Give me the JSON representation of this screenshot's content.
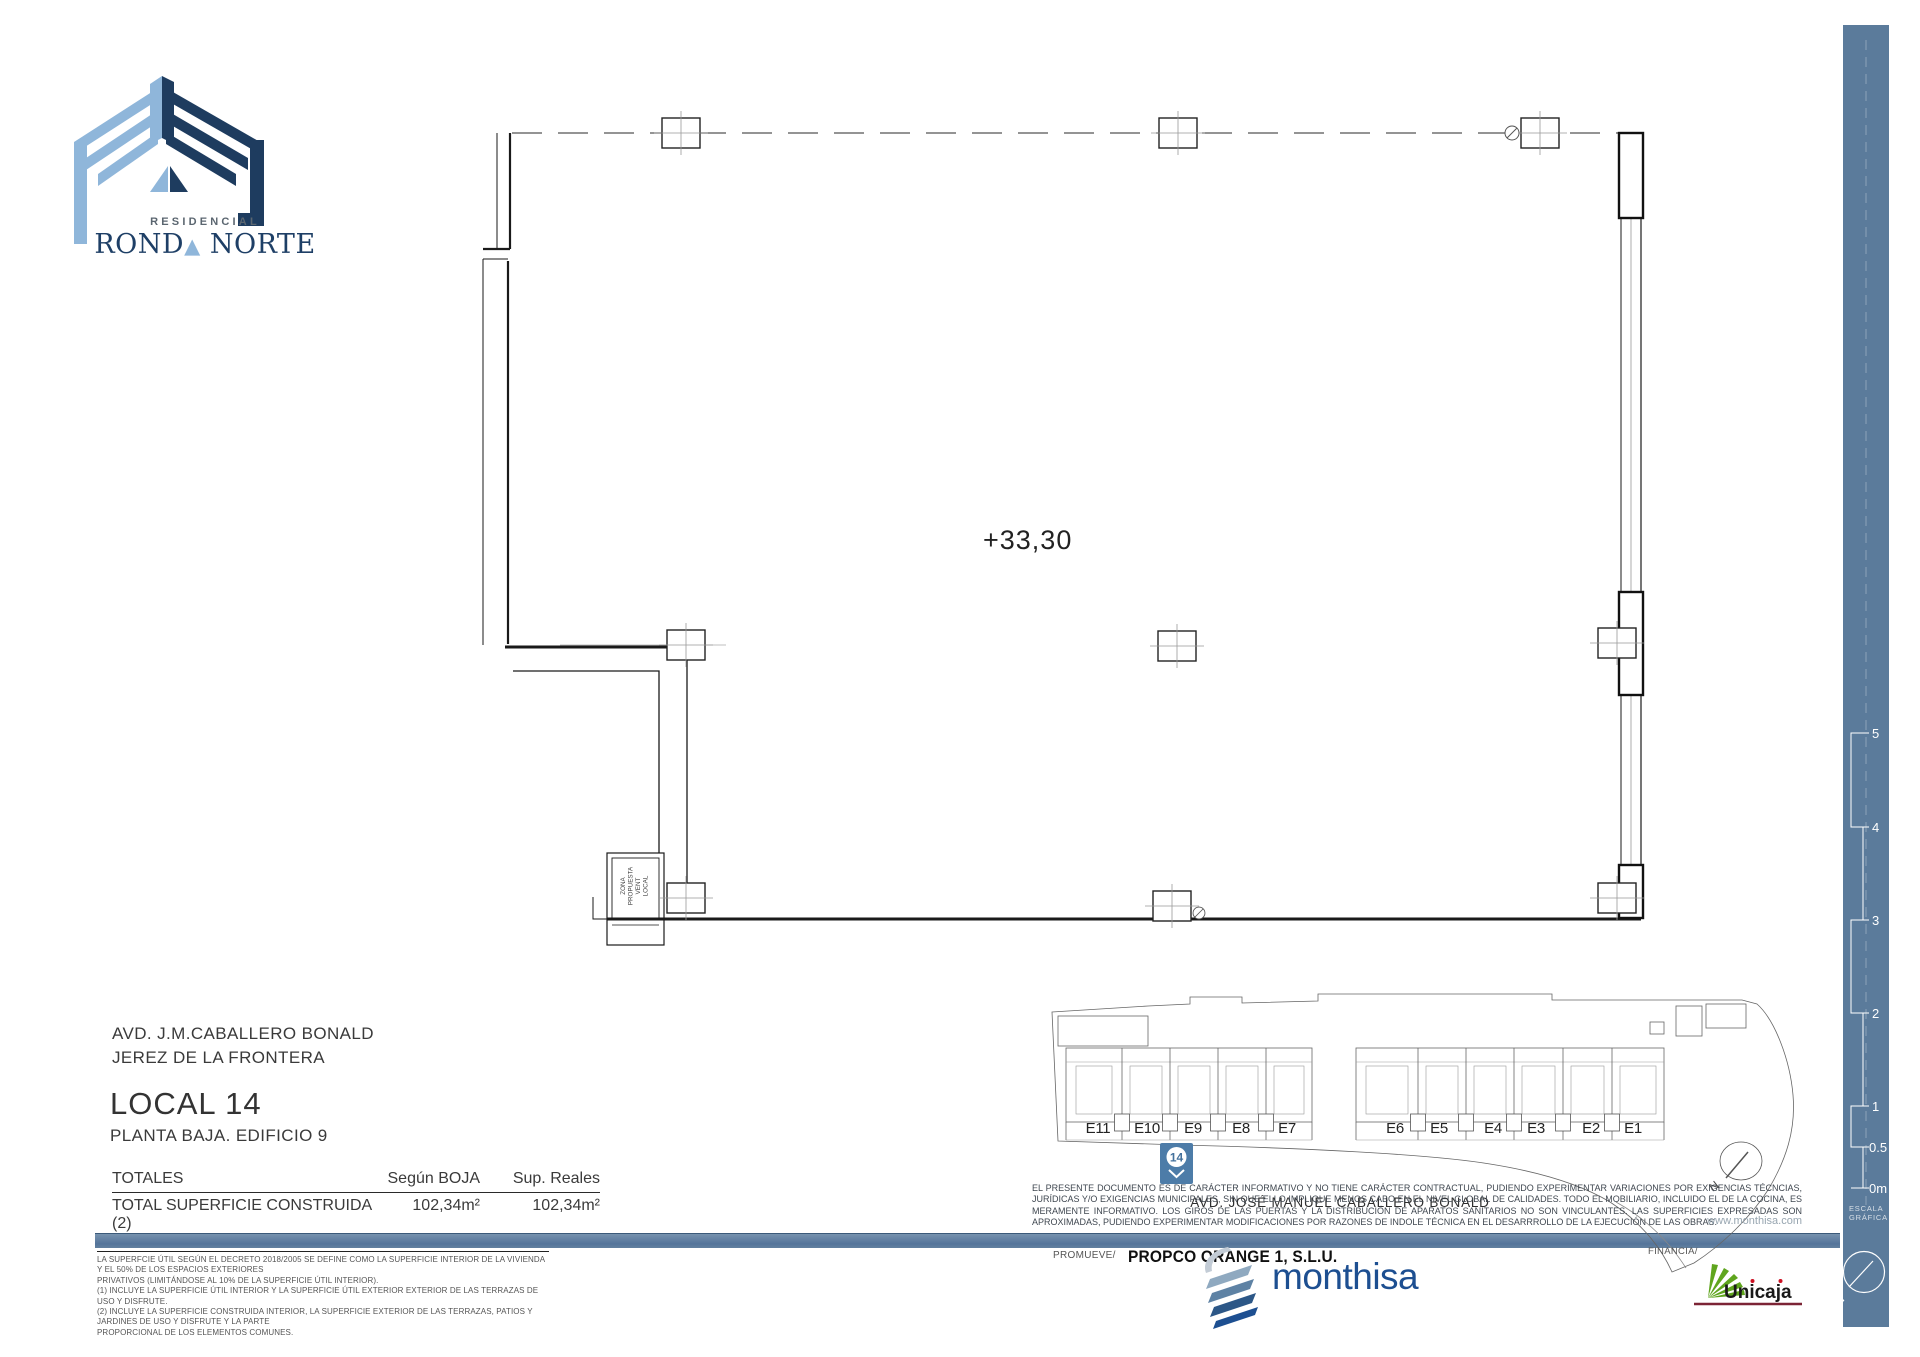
{
  "brand": {
    "residencial": "RESIDENCIAL",
    "name_part1": "ROND",
    "name_triangle": "▲",
    "name_part2": " NORTE"
  },
  "plan": {
    "level_label": "+33,30",
    "vent_room": {
      "line1": "ZONA",
      "line2": "PROPUESTA",
      "line3": "VENT",
      "line4": "LOCAL"
    }
  },
  "project": {
    "address_line1": "AVD. J.M.CABALLERO BONALD",
    "address_line2": "JEREZ DE LA FRONTERA",
    "unit_title": "LOCAL 14",
    "unit_subtitle": "PLANTA BAJA. EDIFICIO 9"
  },
  "totals": {
    "title": "TOTALES",
    "col_boja": "Según BOJA",
    "col_reales": "Sup. Reales",
    "row_label": "TOTAL SUPERFICIE CONSTRUIDA  (2)",
    "row_boja": "102,34m²",
    "row_reales": "102,34m²"
  },
  "footnotes": {
    "line1": "LA SUPERFCIE ÚTIL SEGÚN EL DECRETO 2018/2005 SE DEFINE COMO LA SUPERFICIE INTERIOR DE LA VIVIENDA Y EL 50% DE LOS ESPACIOS EXTERIORES",
    "line2": "PRIVATIVOS (LIMITÁNDOSE AL 10% DE LA SUPERFICIE ÚTIL INTERIOR).",
    "line3": "(1) INCLUYE LA SUPERFICIE ÚTIL INTERIOR Y LA SUPERFICIE ÚTIL EXTERIOR EXTERIOR DE LAS TERRAZAS DE USO Y DISFRUTE.",
    "line4": "(2) INCLUYE LA SUPERFICIE CONSTRUIDA INTERIOR, LA SUPERFICIE EXTERIOR DE LAS TERRAZAS, PATIOS Y JARDINES DE USO Y DISFRUTE  Y LA PARTE",
    "line5": "PROPORCIONAL DE LOS ELEMENTOS COMUNES."
  },
  "site_plan": {
    "units": [
      "E11",
      "E10",
      "E9",
      "E8",
      "E7",
      "E6",
      "E5",
      "E4",
      "E3",
      "E2",
      "E1"
    ],
    "selected_unit": "14",
    "street": "AVD. JOSÉ MANUEL  CABALLERO BONALD",
    "north_label": "N"
  },
  "disclaimer": {
    "text": "EL PRESENTE DOCUMENTO ES DE CARÁCTER INFORMATIVO Y NO TIENE CARÁCTER CONTRACTUAL, PUDIENDO EXPERIMENTAR VARIACIONES POR EXIGENCIAS TÉCNCIAS, JURÍDICAS Y/O EXIGENCIAS MUNICIPALES, SIN QUE ELLO IMPLIQUE MENOS CABO EN EL NIVEL GLOBAL DE CALIDADES. TODO EL MOBILIARIO, INCLUIDO EL DE LA COCINA, ES MERAMENTE INFORMATIVO. LOS GIROS DE LAS PUERTAS Y LA DISTRIBUCIÓN DE APARATOS SANITARIOS NO SON VINCULANTES. LAS SUPERFICIES EXPRESADAS SON APROXIMADAS, PUDIENDO EXPERIMENTAR MODIFICACIONES POR RAZONES DE INDOLE TÉCNICA EN EL DESARRROLLO DE LA EJECUCIÓN DE LAS OBRAS.",
    "website": "www.monthisa.com"
  },
  "footer": {
    "promoter_label": "PROMUEVE/",
    "promoter_name": "PROPCO ORANGE  1, S.L.U.",
    "builder_name": "monthisa",
    "financer_label": "FINANCIA/",
    "financer_name": "Unicaja"
  },
  "scale_bar": {
    "labels": [
      "5",
      "4",
      "3",
      "2",
      "1",
      "0.5",
      "0m"
    ],
    "caption1": "ESCALA",
    "caption2": "GRÁFICA",
    "north_label": "N"
  },
  "colors": {
    "sidebar_blue": "#5b7b9b",
    "marker_blue": "#4d7ca8",
    "logo_light_blue": "#8fb6da",
    "logo_navy": "#1e3c5f",
    "monthisa_blue": "#1d4f91",
    "unicaja_green": "#5fa51e",
    "unicaja_wine": "#7c2435"
  }
}
